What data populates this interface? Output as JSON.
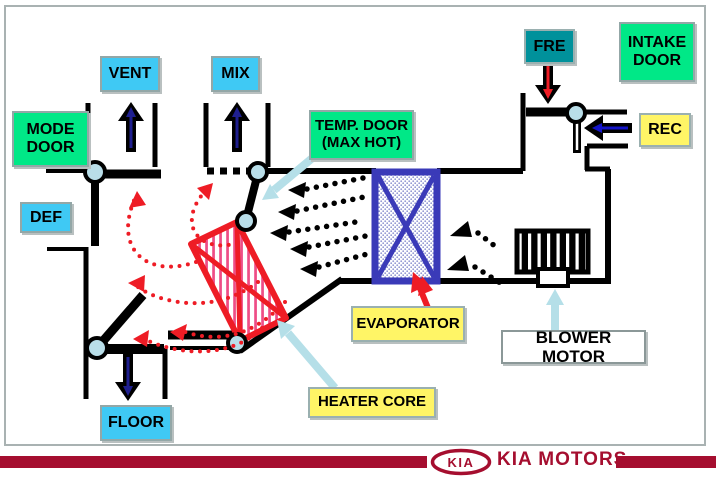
{
  "diagram": {
    "labels": {
      "vent": "VENT",
      "mix": "MIX",
      "mode_door": "MODE DOOR",
      "def": "DEF",
      "temp_door": "TEMP. DOOR (MAX HOT)",
      "fre": "FRE",
      "intake_door": "INTAKE DOOR",
      "rec": "REC",
      "evaporator": "EVAPORATOR",
      "blower_motor": "BLOWER MOTOR",
      "heater_core": "HEATER CORE",
      "floor": "FLOOR"
    }
  },
  "footer": {
    "kia_badge": "KIA",
    "brand": "KIA MOTORS"
  },
  "colors": {
    "green": "#00e887",
    "cyan": "#3fc9f4",
    "teal": "#00919b",
    "yellow": "#fff566",
    "red": "#ee1c25",
    "pink_stripe": "#ee4d86",
    "navy_arrow": "#1f1f8f",
    "blue_arrow": "#1414c8",
    "evap_blue": "#3a3ab8",
    "evap_dot": "#9298d2",
    "pale_blue": "#b5dfe8",
    "pivot_fill": "#b9dee9",
    "kia_red": "#a50e2f"
  }
}
